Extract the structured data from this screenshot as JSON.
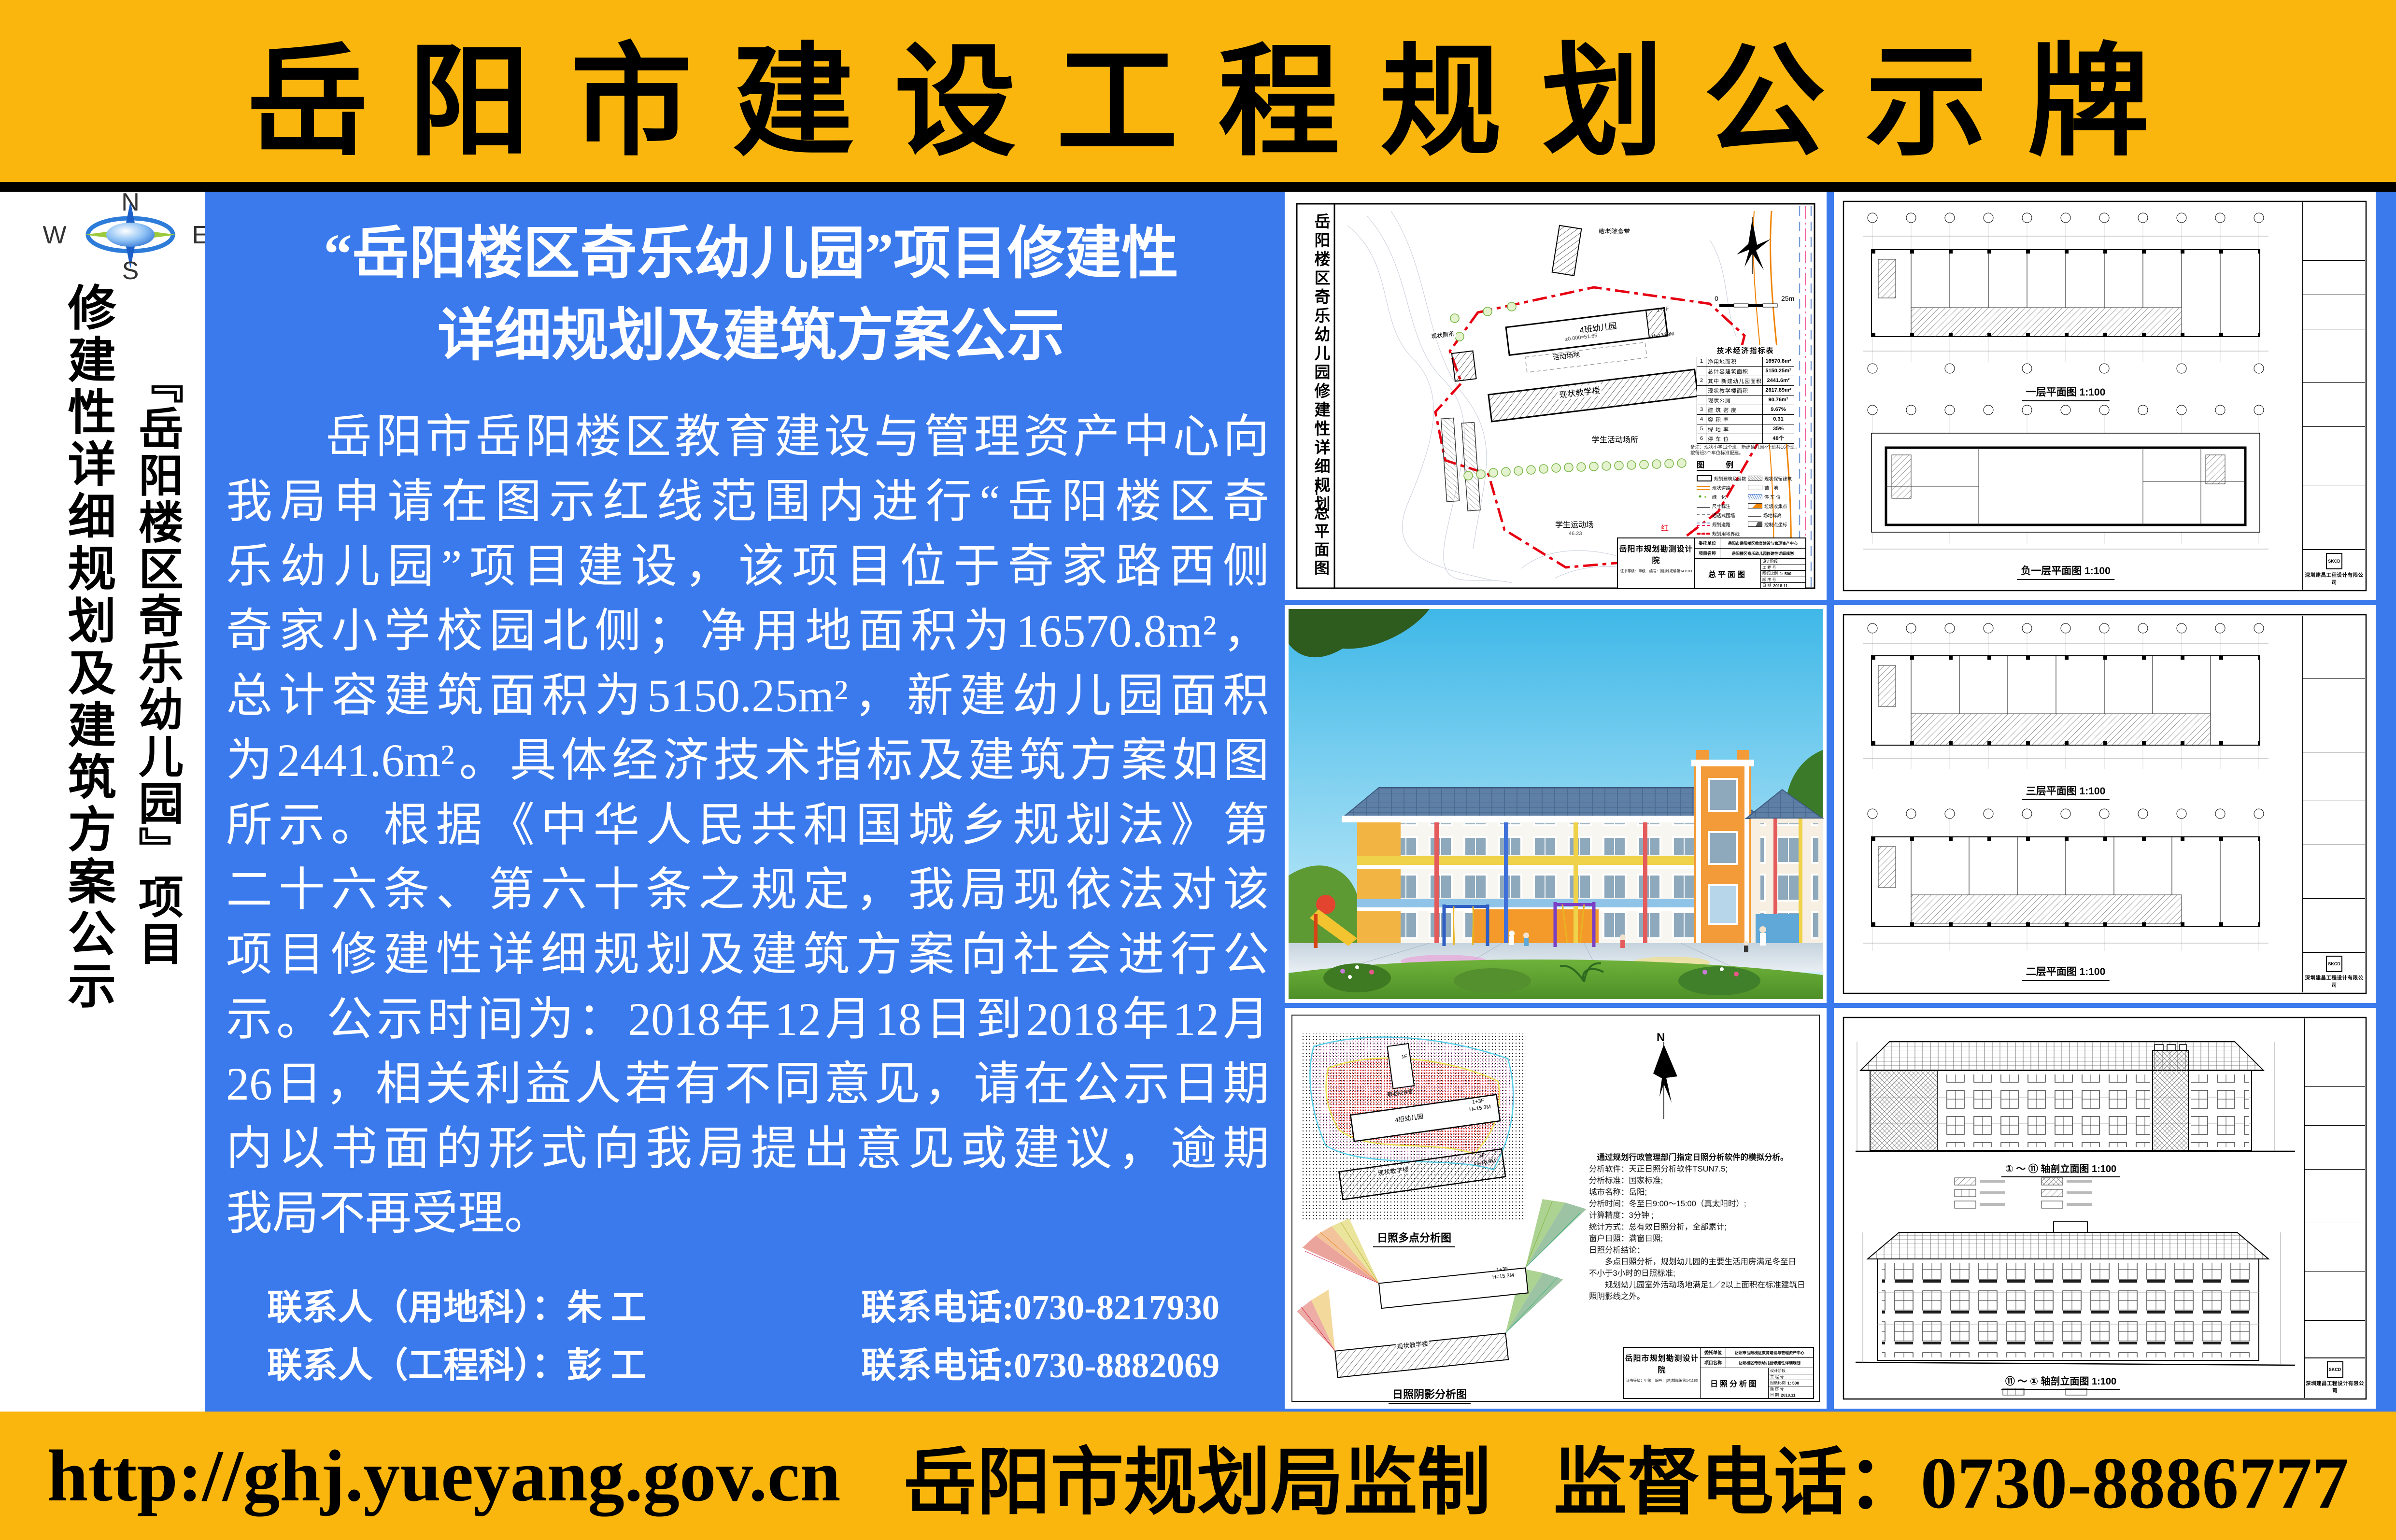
{
  "colors": {
    "yellow": "#FBB60D",
    "blue": "#3B7AEC",
    "red_line": "#E60012",
    "black": "#000000",
    "white": "#FFFFFF"
  },
  "banner": {
    "title": "岳阳市建设工程规划公示牌"
  },
  "footer": {
    "url": "http://ghj.yueyang.gov.cn",
    "maker": "岳阳市规划局监制",
    "phone": "监督电话：0730-8886777"
  },
  "left": {
    "n": "N",
    "w": "W",
    "e": "E",
    "s": "S",
    "project_col": "『岳阳楼区奇乐幼儿园』项目",
    "plan_col": "修建性详细规划及建筑方案公示"
  },
  "notice": {
    "title1": "“岳阳楼区奇乐幼儿园”项目修建性",
    "title2": "详细规划及建筑方案公示",
    "body": [
      "　　岳阳市岳阳楼区教育建设与管理资产中心向",
      "我局申请在图示红线范围内进行“岳阳楼区奇",
      "乐幼儿园”项目建设，该项目位于奇家路西侧",
      "奇家小学校园北侧；净用地面积为16570.8m²，",
      "总计容建筑面积为5150.25m²，新建幼儿园面积",
      "为2441.6m²。具体经济技术指标及建筑方案如图",
      "所示。根据《中华人民共和国城乡规划法》第",
      "二十六条、第六十条之规定，我局现依法对该",
      "项目修建性详细规划及建筑方案向社会进行公",
      "示。公示时间为：2018年12月18日到2018年12月",
      "26日，相关利益人若有不同意见，请在公示日期",
      "内以书面的形式向我局提出意见或建议，逾期",
      "我局不再受理。"
    ],
    "contact1_person": "联系人（用地科）：朱 工",
    "contact1_phone": "联系电话:0730-8217930",
    "contact2_person": "联系人（工程科）：彭 工",
    "contact2_phone": "联系电话:0730-8882069"
  },
  "siteplan": {
    "side_title": "岳阳楼区奇乐幼儿园修建性详细规划",
    "side_sub": "总平面图",
    "bld_canteen": "敬老院食堂",
    "bld_kg": "4班幼儿园",
    "kg_tag": "1+3F",
    "kg_h": "H=13.89M",
    "lvl": "±0.000=51.65",
    "bld_activity": "活动场地",
    "bld_teach": "现状教学楼",
    "bld_toilet": "现状厕所",
    "area_student": "学生活动场所",
    "area_sport": "学生运动场",
    "sport_lvl": "46.23",
    "road": "红岭路",
    "scale0": "0",
    "scale25": "25m",
    "table_title": "技术经济指标表",
    "t": [
      {
        "n": "1",
        "k": "净用地面积",
        "v": "16570.8m²"
      },
      {
        "n": "",
        "k": "总计容建筑面积",
        "v": "5150.25m²"
      },
      {
        "n": "2",
        "k": "其中 新建幼儿园面积",
        "v": "2441.6m²"
      },
      {
        "n": "",
        "k": "现状教学楼面积",
        "v": "2617.89m²"
      },
      {
        "n": "",
        "k": "现状公厕",
        "v": "90.76m²"
      },
      {
        "n": "3",
        "k": "建 筑 密 度",
        "v": "9.67%"
      },
      {
        "n": "4",
        "k": "容 积 率",
        "v": "0.31"
      },
      {
        "n": "5",
        "k": "绿 地 率",
        "v": "35%"
      },
      {
        "n": "6",
        "k": "停 车 位",
        "v": "48个"
      }
    ],
    "note": "备注：现状小学12个班，新建幼儿园4个班共16个班，按每班3个车位标准配建。",
    "legend_title": "图　例",
    "legend": [
      "规划建筑及层数",
      "现状保留建筑",
      "现状道路",
      "铺　地",
      "绿　化",
      "停 车 位",
      "尺寸标注",
      "垃圾收集点",
      "通透式围墙",
      "场地标高",
      "规划道路",
      "控制点坐标",
      "规划用地界线"
    ],
    "tb_institute": "岳阳市规划勘测设计院",
    "tb_cert": "证书等级：甲级　编号：[建]城规编第141183",
    "tb_client_k": "委托单位",
    "tb_client": "岳阳市岳阳楼区教育建设与管理资产中心",
    "tb_project_k": "项目名称",
    "tb_project": "岳阳楼区奇乐幼儿园修建性详细规划",
    "tb_drawing": "总平面图",
    "tb_stage": "设计阶段",
    "tb_no": "工 程 号",
    "tb_scale_k": "图纸比例",
    "tb_scale": "1: 500",
    "tb_seq": "顺 序 号",
    "tb_date_k": "日 期",
    "tb_date": "2018.11"
  },
  "plans1": {
    "label1": "一层平面图 1:100",
    "label2": "负一层平面图 1:100",
    "company": "深圳建昌工程设计有限公司",
    "logo": "SKCD"
  },
  "plans2": {
    "label1": "三层平面图 1:100",
    "label2": "二层平面图 1:100",
    "company": "深圳建昌工程设计有限公司",
    "logo": "SKCD"
  },
  "sun": {
    "north": "N",
    "label_multi": "日照多点分析图",
    "label_shadow": "日照阴影分析图",
    "lines": [
      "　通过规划行政管理部门指定日照分析软件的模拟分析。",
      "分析软件：天正日照分析软件TSUN7.5;",
      "分析标准：国家标准;",
      "城市名称：岳阳;",
      "分析时间：冬至日9:00～15:00（真太阳时）;",
      "计算精度：3分钟 ;",
      "统计方式：总有效日照分析，全部累计;",
      "窗户日照：满窗日照;",
      "日照分析结论：",
      "　　多点日照分析，规划幼儿园的主要生活用房满足冬至日",
      "不小于3小时的日照标准;",
      "　　规划幼儿园室外活动场地满足1／2以上面积在标准建筑日",
      "照阴影线之外。"
    ],
    "canteen": "敬老院食堂",
    "canteen_tag": "1F",
    "b1_name": "4班幼儿园",
    "b1_tag": "1+3F",
    "b1_h": "H=15.3M",
    "b2_name": "现状教学楼",
    "b2_tag": "3F",
    "b2_h": "H=10.9M",
    "tb_institute": "岳阳市规划勘测设计院",
    "tb_cert": "证书等级：甲级　编号：[建]城规编第141183",
    "tb_client_k": "委托单位",
    "tb_client": "岳阳市岳阳楼区教育建设与管理资产中心",
    "tb_project_k": "项目名称",
    "tb_project": "岳阳楼区奇乐幼儿园修建性详细规划",
    "tb_drawing": "日照分析图",
    "tb_stage": "设计阶段",
    "tb_no": "工 程 号",
    "tb_scale_k": "图纸比例",
    "tb_scale": "1: 500",
    "tb_seq": "顺 序 号",
    "tb_date_k": "日 期",
    "tb_date": "2018.11"
  },
  "elev": {
    "label1": "① ～ ⑪ 轴剖立面图 1:100",
    "label2": "⑪ ～ ① 轴剖立面图 1:100",
    "company": "深圳建昌工程设计有限公司",
    "logo": "SKCD"
  }
}
